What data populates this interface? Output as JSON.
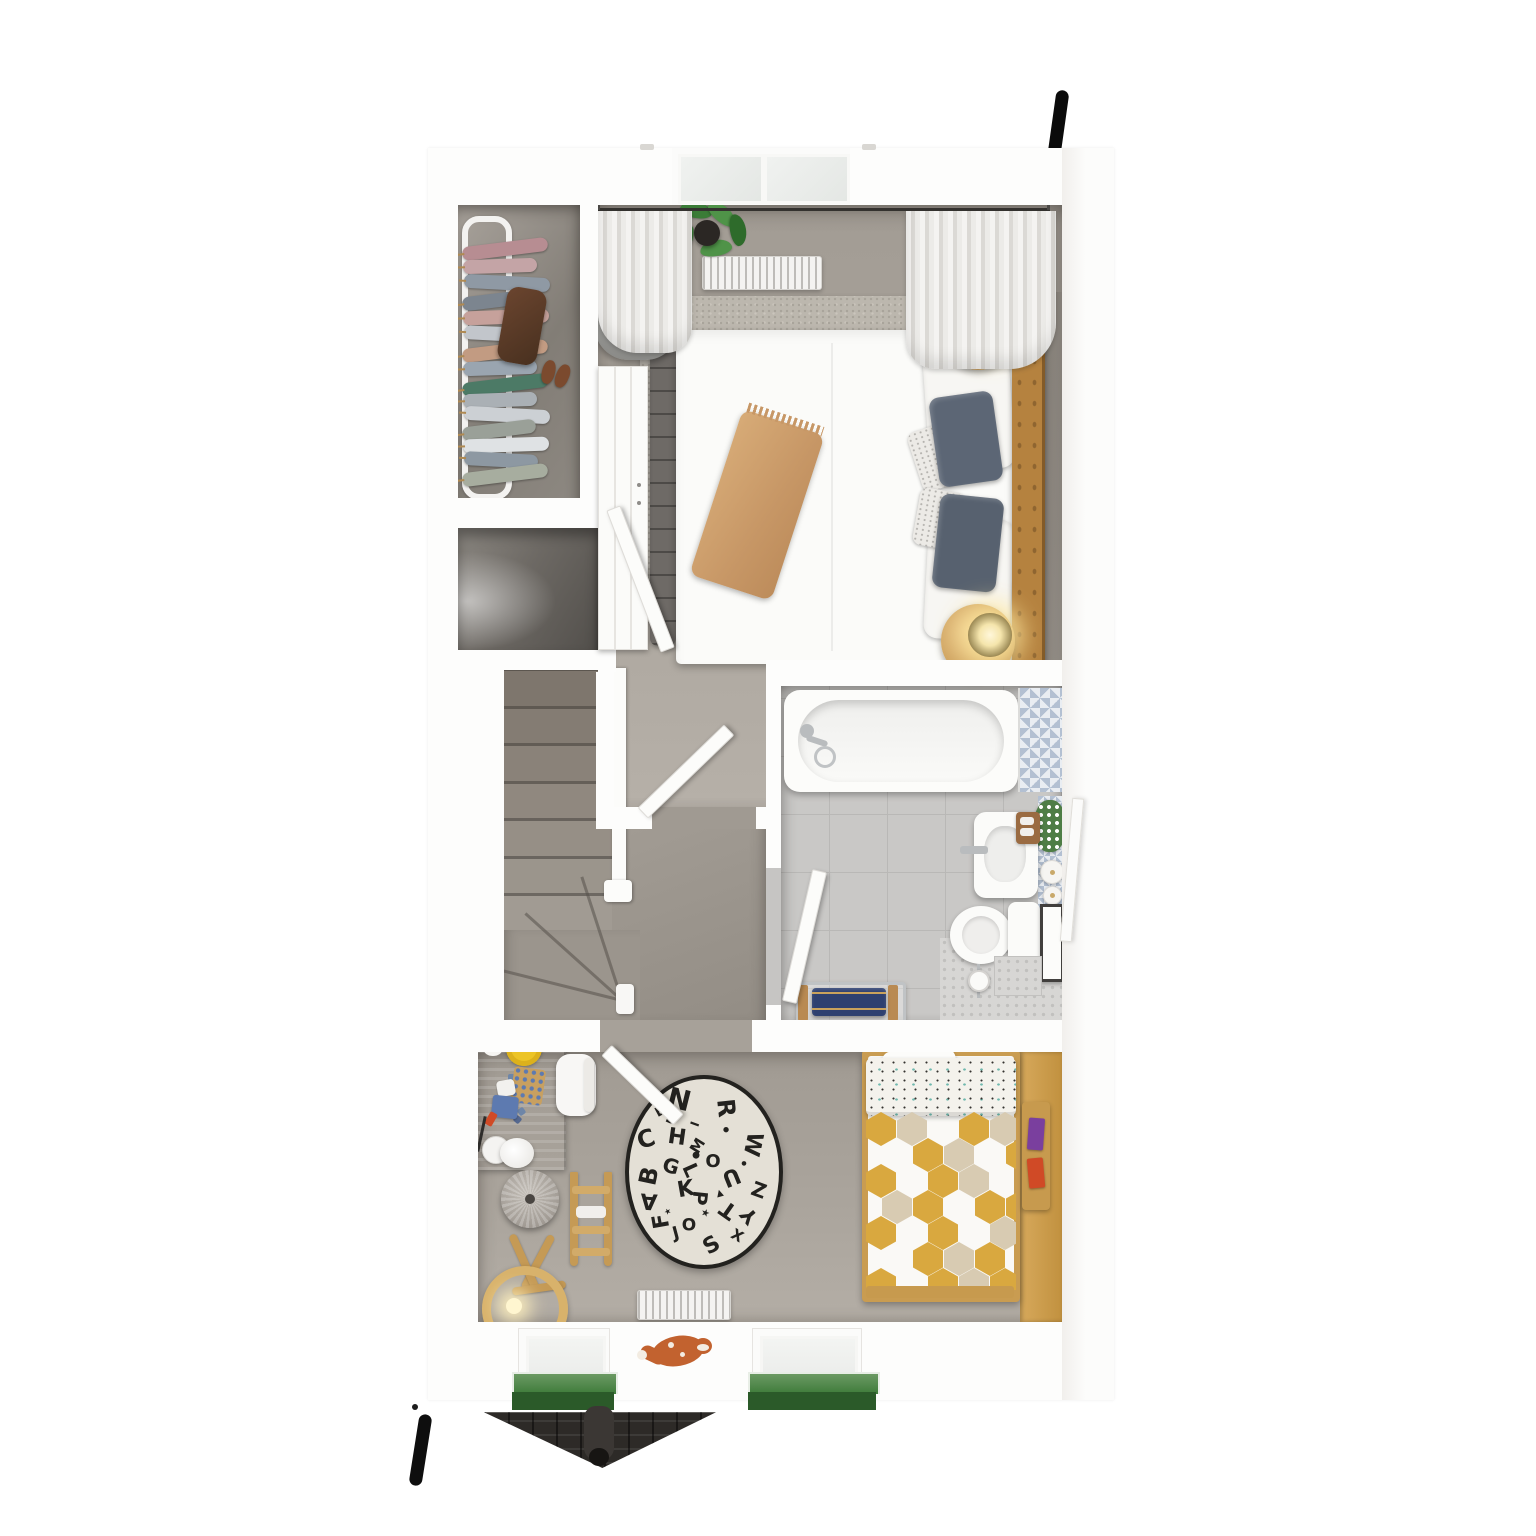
{
  "rooms": [
    "master-bedroom",
    "walk-in-wardrobe",
    "stairwell",
    "landing",
    "bathroom",
    "kids-bedroom"
  ],
  "palette": {
    "wall": "#fdfdfc",
    "exterior": "#ffffff",
    "carpet_bedroom": "#a8a29a",
    "carpet_kids": "#a39d95",
    "carpet_landing": "#9a948c",
    "carpet_closet": "#8f8a83",
    "tile_floor": "#c9c8c6",
    "accent_tile_blue": "#b3c0d2",
    "wood": "#cda15e",
    "headboard_camel": "#b5823f",
    "pillow_blue": "#5c6675",
    "throw_tan": "#cda26f",
    "towel_navy": "#2e4070",
    "window_box_green": "#3e7b3a",
    "roof_dark": "#2d2a27",
    "accent_black": "#0b0b0b",
    "plant_green": "#3b7c37",
    "lamp_glow": "#ffedb0",
    "fox_orange": "#c2622f",
    "duvet_gold": "#d9a83f",
    "duvet_beige": "#d8cbb2",
    "yellow_plate": "#ecc426"
  },
  "closet": {
    "hanger": "#b08a52",
    "top_garments": [
      "#b78d92",
      "#c4a4a6",
      "#8f99a4",
      "#7c858f",
      "#c6a19b",
      "#c2c6cb",
      "#c29b82",
      "#9aa5b0"
    ],
    "bottom_garments": [
      "#4c7a66",
      "#aab0b5",
      "#ccd0d4",
      "#9aa098",
      "#dfe2e4",
      "#8d98a2",
      "#a7ad9f"
    ]
  },
  "stairs": {
    "step_count": 7,
    "winder_angles": [
      14,
      42,
      72
    ]
  },
  "alphabet_rug": {
    "bg": "#e4e0d6",
    "ring": "#23221f",
    "letters": [
      {
        "ch": "N",
        "dx": -25,
        "dy": -72,
        "rot": 14,
        "s": 28
      },
      {
        "ch": "E",
        "dx": -44,
        "dy": -60,
        "rot": -28,
        "s": 13
      },
      {
        "ch": "D",
        "dx": -33,
        "dy": -52,
        "rot": 24,
        "s": 13
      },
      {
        "ch": "I",
        "dx": -9,
        "dy": -48,
        "rot": -70,
        "s": 12
      },
      {
        "ch": "R",
        "dx": 22,
        "dy": -64,
        "rot": 84,
        "s": 24
      },
      {
        "ch": "W",
        "dx": 48,
        "dy": -28,
        "rot": 102,
        "s": 22
      },
      {
        "ch": "C",
        "dx": -58,
        "dy": -33,
        "rot": -18,
        "s": 24
      },
      {
        "ch": "H",
        "dx": -27,
        "dy": -34,
        "rot": 8,
        "s": 22
      },
      {
        "ch": "M",
        "dx": -6,
        "dy": -26,
        "rot": -58,
        "s": 15
      },
      {
        "ch": "O",
        "dx": 9,
        "dy": -10,
        "rot": 0,
        "s": 18
      },
      {
        "ch": "B",
        "dx": -55,
        "dy": 4,
        "rot": -78,
        "s": 24
      },
      {
        "ch": "G",
        "dx": -33,
        "dy": -6,
        "rot": 16,
        "s": 20
      },
      {
        "ch": "L",
        "dx": -13,
        "dy": -2,
        "rot": 66,
        "s": 20
      },
      {
        "ch": "U",
        "dx": 27,
        "dy": 4,
        "rot": 158,
        "s": 22
      },
      {
        "ch": "A",
        "dx": -55,
        "dy": 28,
        "rot": 184,
        "s": 22
      },
      {
        "ch": "Z",
        "dx": 55,
        "dy": 18,
        "rot": 20,
        "s": 20
      },
      {
        "ch": "K",
        "dx": -18,
        "dy": 18,
        "rot": -10,
        "s": 22
      },
      {
        "ch": "P",
        "dx": -4,
        "dy": 26,
        "rot": 96,
        "s": 20
      },
      {
        "ch": "T",
        "dx": 25,
        "dy": 37,
        "rot": -145,
        "s": 22
      },
      {
        "ch": "Y",
        "dx": 45,
        "dy": 44,
        "rot": -130,
        "s": 20
      },
      {
        "ch": "F",
        "dx": -42,
        "dy": 49,
        "rot": -100,
        "s": 22
      },
      {
        "ch": "O",
        "dx": -15,
        "dy": 54,
        "rot": 0,
        "s": 17
      },
      {
        "ch": "J",
        "dx": -28,
        "dy": 62,
        "rot": -15,
        "s": 17
      },
      {
        "ch": "X",
        "dx": 33,
        "dy": 64,
        "rot": 30,
        "s": 15
      },
      {
        "ch": "S",
        "dx": 8,
        "dy": 74,
        "rot": -30,
        "s": 22
      }
    ],
    "doodles": [
      {
        "ch": "★",
        "dx": 1,
        "dy": 42,
        "rot": 20,
        "s": 10
      },
      {
        "ch": "●",
        "dx": -8,
        "dy": -16,
        "rot": 0,
        "s": 9
      },
      {
        "ch": "▲",
        "dx": 16,
        "dy": 22,
        "rot": -15,
        "s": 9
      },
      {
        "ch": "●",
        "dx": 40,
        "dy": -8,
        "rot": 0,
        "s": 6
      },
      {
        "ch": "★",
        "dx": -36,
        "dy": 40,
        "rot": -30,
        "s": 8
      },
      {
        "ch": "●",
        "dx": 22,
        "dy": -42,
        "rot": 0,
        "s": 7
      }
    ]
  },
  "kids_bed": {
    "hex_colors": {
      "g": "#d9a83f",
      "b": "#d8cbb2"
    },
    "pattern": [
      [
        "g",
        "b",
        "w",
        "g",
        "b"
      ],
      [
        "w",
        "g",
        "b",
        "w",
        "g"
      ],
      [
        "g",
        "w",
        "g",
        "b",
        "w"
      ],
      [
        "b",
        "g",
        "w",
        "g",
        "g"
      ],
      [
        "g",
        "w",
        "g",
        "w",
        "b"
      ],
      [
        "w",
        "g",
        "b",
        "g",
        "w"
      ],
      [
        "g",
        "w",
        "g",
        "b",
        "g"
      ]
    ]
  },
  "books": [
    "#7a3f9e",
    "#d04a26"
  ],
  "desk_toys": {
    "colors": [
      "#6e86a8",
      "#41548a",
      "#8fa3bd",
      "#b7c3d4",
      "#41548a",
      "#6e86a8",
      "#9fb0c6",
      "#55688f"
    ],
    "positions": [
      [
        30,
        28
      ],
      [
        42,
        34
      ],
      [
        34,
        44
      ],
      [
        46,
        50
      ],
      [
        28,
        56
      ],
      [
        40,
        62
      ],
      [
        52,
        40
      ],
      [
        36,
        70
      ]
    ]
  },
  "leaves": [
    {
      "x": 655,
      "y": 212,
      "rot": -30,
      "c": "#2e6b2b"
    },
    {
      "x": 680,
      "y": 202,
      "rot": 10,
      "c": "#3b7c37"
    },
    {
      "x": 706,
      "y": 206,
      "rot": 40,
      "c": "#4f9348"
    },
    {
      "x": 722,
      "y": 222,
      "rot": 80,
      "c": "#2e6b2b"
    },
    {
      "x": 668,
      "y": 232,
      "rot": -70,
      "c": "#3b7c37"
    },
    {
      "x": 700,
      "y": 240,
      "rot": -10,
      "c": "#4f9348"
    }
  ]
}
